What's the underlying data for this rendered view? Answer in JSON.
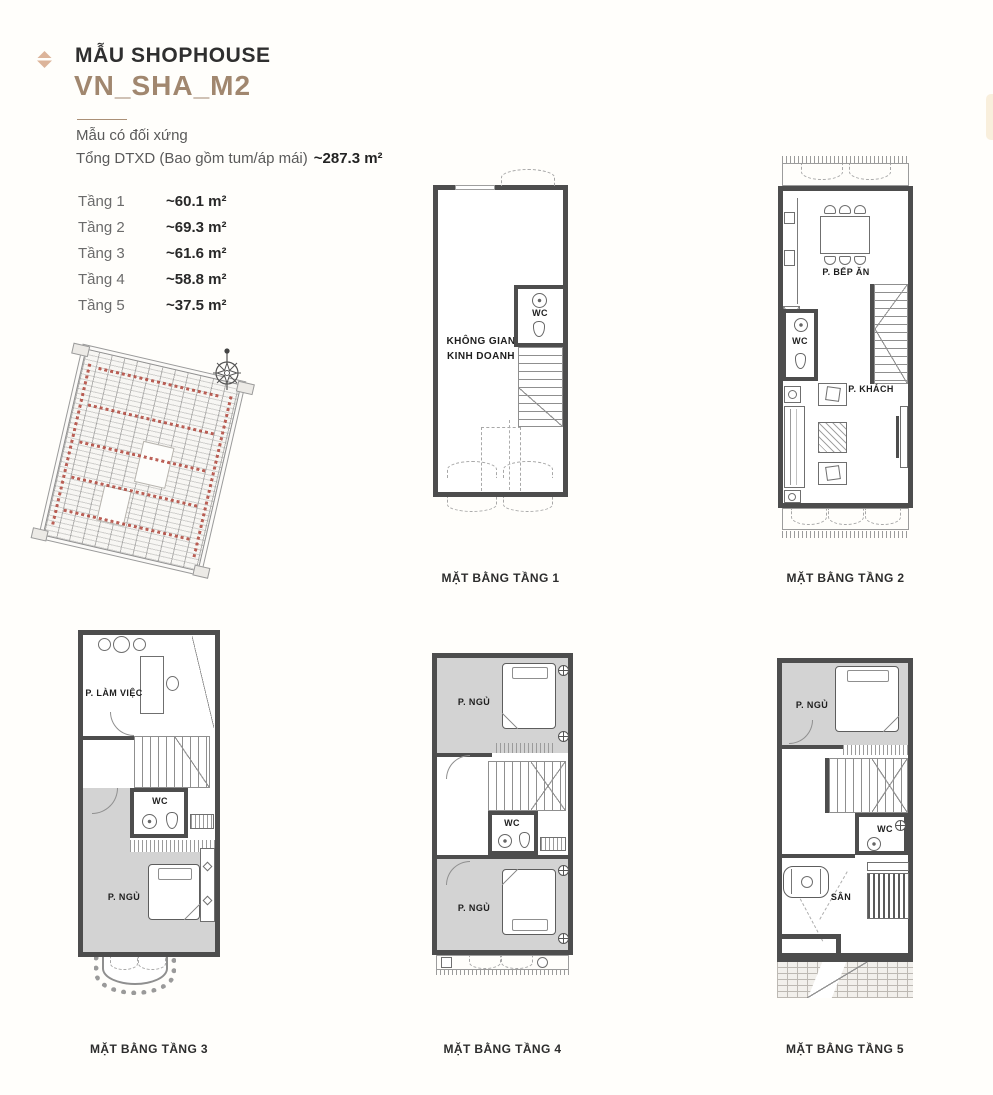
{
  "header": {
    "kicker": "MẪU SHOPHOUSE",
    "model": "VN_SHA_M2",
    "subtitle": "Mẫu có đối xứng",
    "total_label": "Tổng DTXD (Bao gồm tum/áp mái)",
    "total_value": "~287.3 m²",
    "floors": [
      {
        "label": "Tầng 1",
        "area": "~60.1 m²"
      },
      {
        "label": "Tầng 2",
        "area": "~69.3 m²"
      },
      {
        "label": "Tầng 3",
        "area": "~61.6 m²"
      },
      {
        "label": "Tầng 4",
        "area": "~58.8 m²"
      },
      {
        "label": "Tầng 5",
        "area": "~37.5 m²"
      }
    ]
  },
  "plans": {
    "floor1": {
      "caption": "MẶT BẰNG TẦNG 1",
      "rooms": {
        "business_line1": "KHÔNG GIAN",
        "business_line2": "KINH DOANH",
        "wc": "WC"
      }
    },
    "floor2": {
      "caption": "MẶT BẰNG TẦNG 2",
      "rooms": {
        "kitchen": "P. BẾP ĂN",
        "wc": "WC",
        "living": "P. KHÁCH"
      }
    },
    "floor3": {
      "caption": "MẶT BẰNG TẦNG 3",
      "rooms": {
        "office": "P. LÀM VIỆC",
        "wc": "WC",
        "bedroom": "P. NGỦ"
      }
    },
    "floor4": {
      "caption": "MẶT BẰNG TẦNG 4",
      "rooms": {
        "bedroom_top": "P. NGỦ",
        "wc": "WC",
        "bedroom_bottom": "P. NGỦ"
      }
    },
    "floor5": {
      "caption": "MẶT BẰNG TẦNG 5",
      "rooms": {
        "bedroom": "P. NGỦ",
        "wc": "WC",
        "terrace": "SÂN"
      }
    }
  },
  "icons": {
    "bullet": "diamond-icon",
    "site_compass": "compass-rose-icon"
  },
  "colors": {
    "accent": "#a1876f",
    "badge": "#dcb49a",
    "wall": "#4d4d4d",
    "room_fill": "#d3d3d3",
    "text_dark": "#2f2f2f",
    "text_muted": "#5f5f5f",
    "site_red": "#b0453a"
  }
}
